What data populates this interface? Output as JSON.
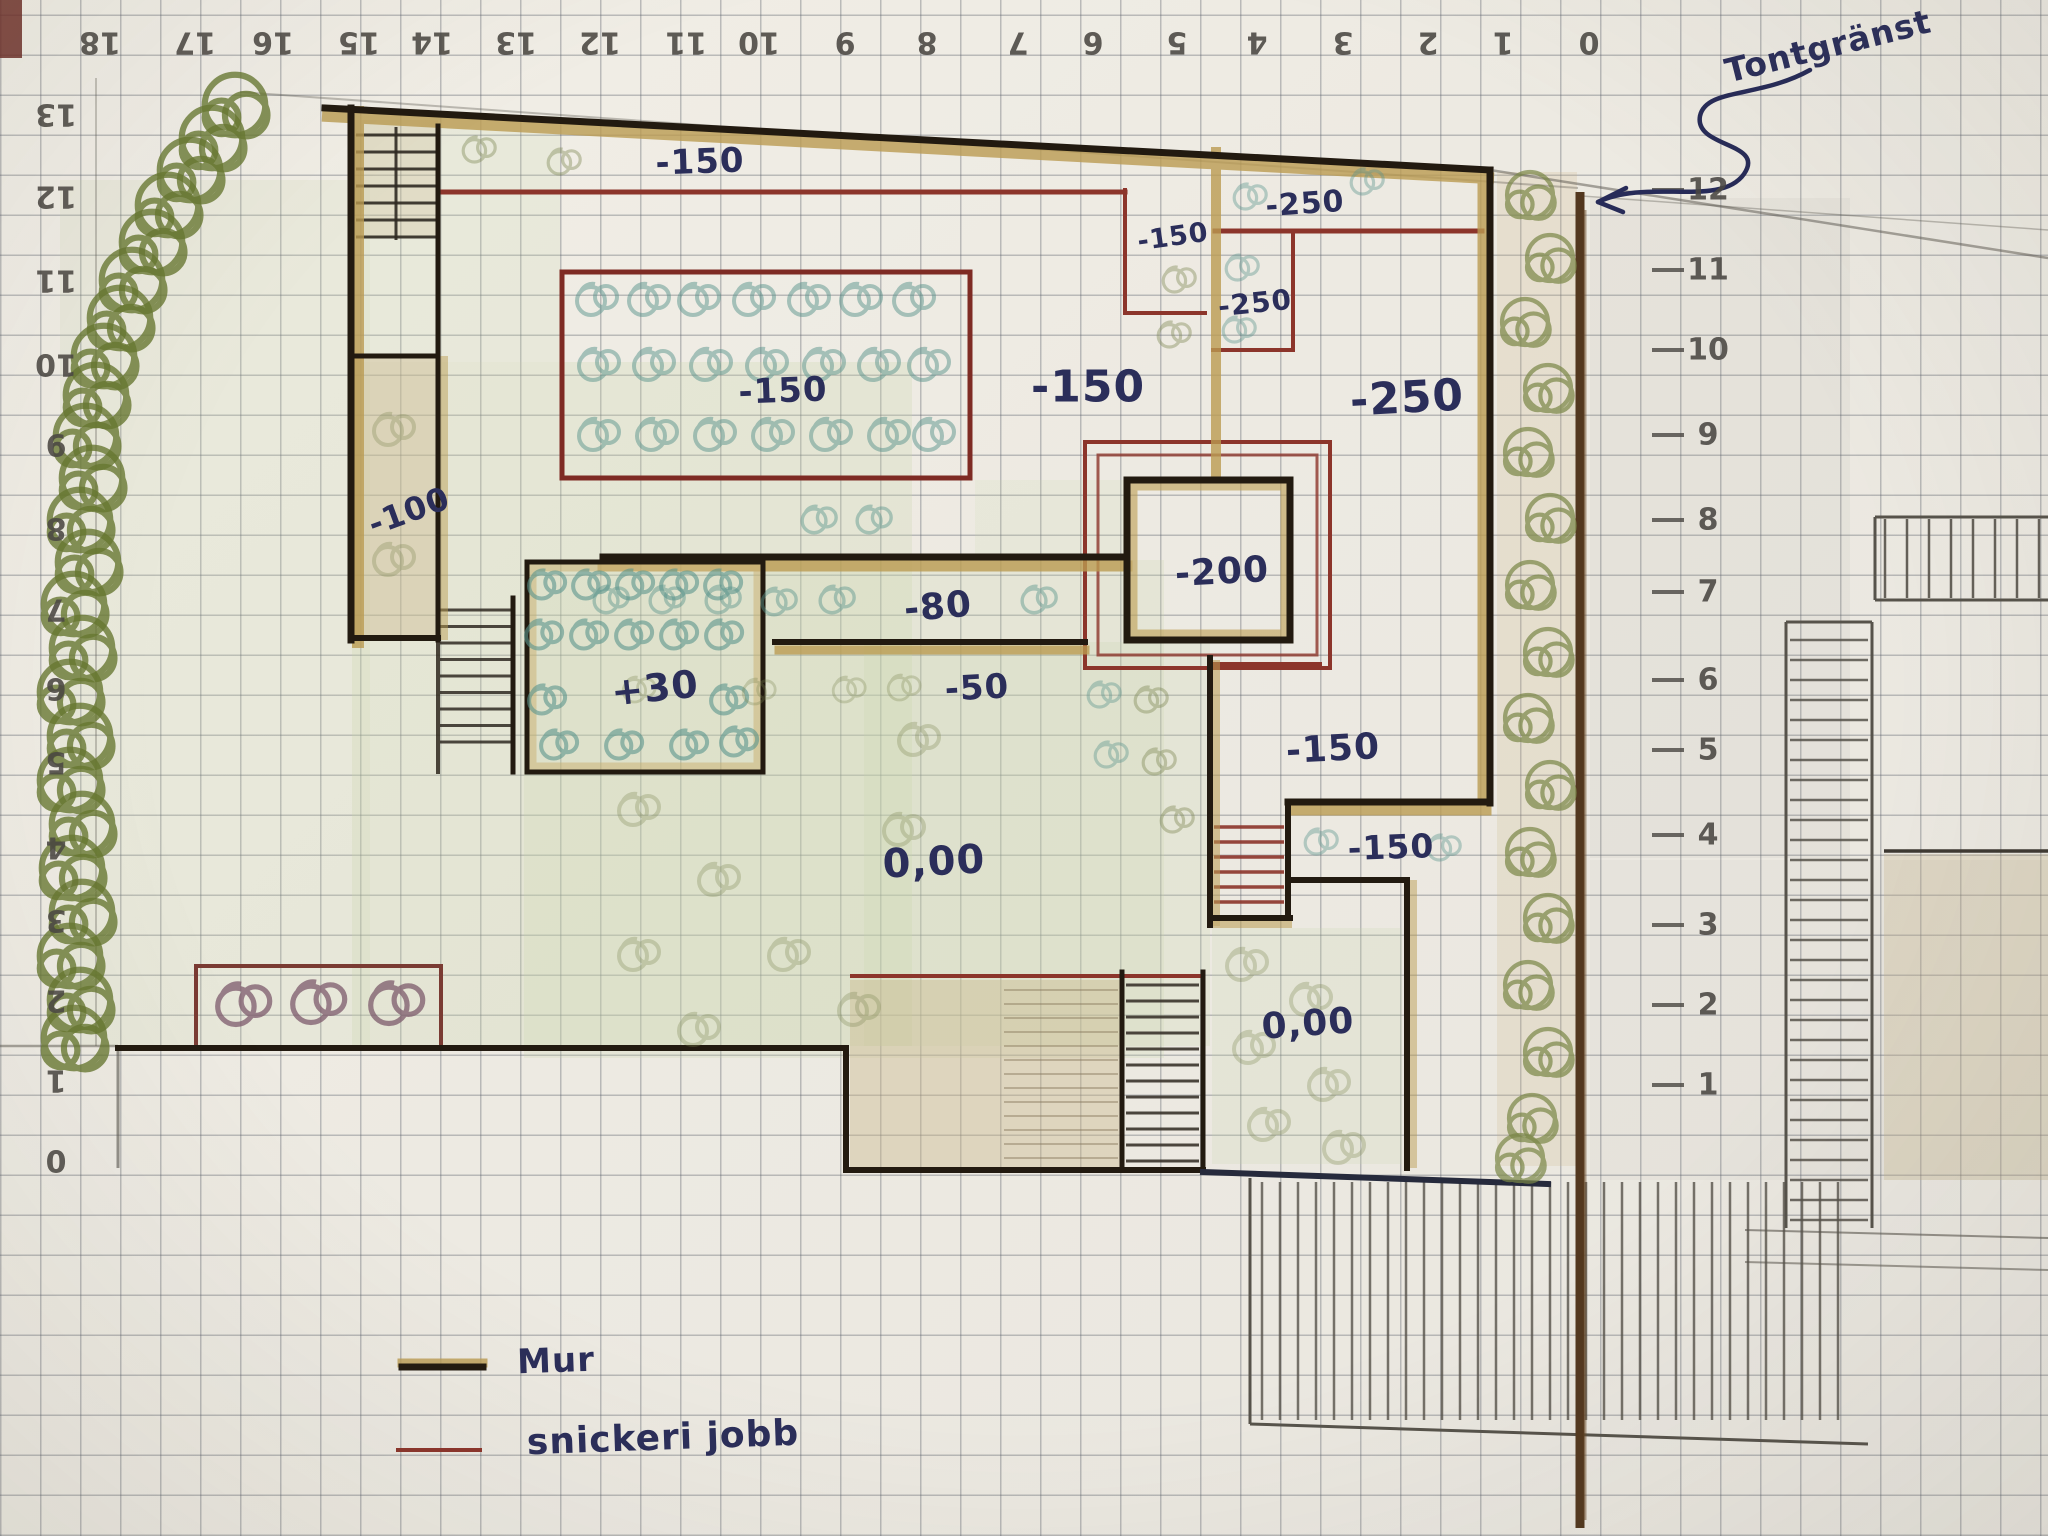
{
  "plan": {
    "title_note": "hand-drawn garden elevation plan",
    "boundary_label": "Tontgränst",
    "legend": [
      {
        "label": "Mur",
        "color": "#221a10"
      },
      {
        "label": "snickeri jobb",
        "color": "#8c352b"
      }
    ],
    "elevations": [
      "-150",
      "-150",
      "-250",
      "-250",
      "-150",
      "-250",
      "-150",
      "-100",
      "-200",
      "-80",
      "-50",
      "+30",
      "-150",
      "-150",
      "0,00",
      "0,00"
    ],
    "axes": {
      "top": [
        "18",
        "17",
        "16",
        "15",
        "14",
        "13",
        "12",
        "11",
        "10",
        "9",
        "8",
        "7",
        "6",
        "5",
        "4",
        "3",
        "2",
        "1",
        "0"
      ],
      "left": [
        "13",
        "12",
        "11",
        "10",
        "9",
        "8",
        "7",
        "6",
        "5",
        "4",
        "3",
        "2",
        "1",
        "0"
      ],
      "right": [
        "12",
        "11",
        "10",
        "9",
        "8",
        "7",
        "6",
        "5",
        "4",
        "3",
        "2",
        "1"
      ]
    },
    "colors": {
      "ink": "#2b2e5a",
      "wall": "#221a10",
      "wall_highlight": "#bb9c52",
      "carpentry_red": "#8c352b",
      "boundary_brown": "#53381f",
      "hedge_green": "#66762f",
      "plant_teal": "#5a948c",
      "lawn_green": "#c9d6ab",
      "pencil": "#57534b",
      "paper": "#efece4"
    }
  }
}
